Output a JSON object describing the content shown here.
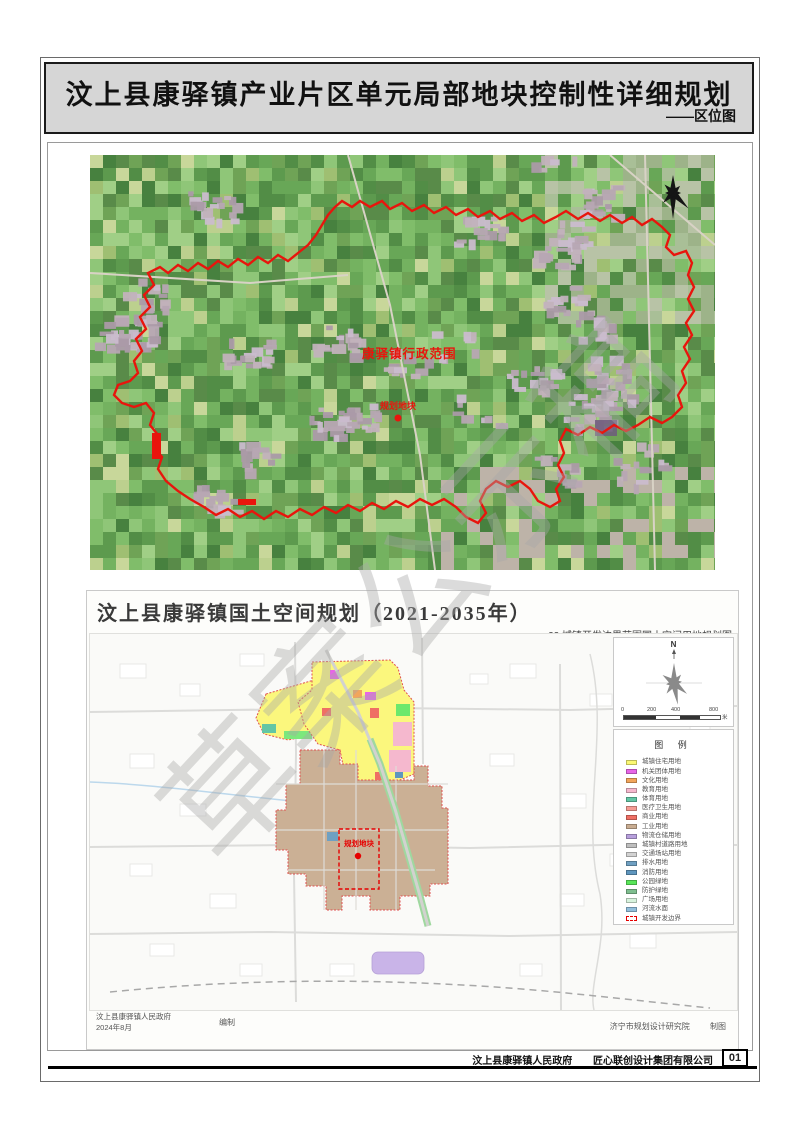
{
  "header": {
    "title": "汶上县康驿镇产业片区单元局部地块控制性详细规划",
    "subtitle": "——区位图"
  },
  "watermark": "草案公示稿",
  "satellite_map": {
    "region_label": "康驿镇行政范围",
    "plot_label": "规划地块",
    "boundary_color": "#e8150d"
  },
  "lower_map": {
    "title": "汶上县康驿镇国土空间规划（2021-2035年）",
    "subtitle": "22 城镇开发边界范围国土空间用地规划图",
    "north_label": "N",
    "scale_bar": {
      "ticks": [
        "0",
        "200",
        "400",
        "800"
      ],
      "unit": "米"
    },
    "legend_title": "图 例",
    "legend": [
      {
        "label": "城镇住宅用地",
        "color": "#fbf873",
        "type": "fill"
      },
      {
        "label": "机关团体用地",
        "color": "#e766e7",
        "type": "fill"
      },
      {
        "label": "文化用地",
        "color": "#f2a55b",
        "type": "fill"
      },
      {
        "label": "教育用地",
        "color": "#f5b8ce",
        "type": "fill"
      },
      {
        "label": "体育用地",
        "color": "#63c6a5",
        "type": "fill"
      },
      {
        "label": "医疗卫生用地",
        "color": "#f49c94",
        "type": "fill"
      },
      {
        "label": "商业用地",
        "color": "#ef6f64",
        "type": "fill"
      },
      {
        "label": "工业用地",
        "color": "#c9ad92",
        "type": "fill"
      },
      {
        "label": "物流仓储用地",
        "color": "#b79fdc",
        "type": "fill"
      },
      {
        "label": "城镇村道路用地",
        "color": "#bebebe",
        "type": "fill"
      },
      {
        "label": "交通场站用地",
        "color": "#d2d2d2",
        "type": "fill"
      },
      {
        "label": "排水用地",
        "color": "#6fa0c2",
        "type": "fill"
      },
      {
        "label": "消防用地",
        "color": "#5e96be",
        "type": "fill"
      },
      {
        "label": "公园绿地",
        "color": "#59e659",
        "type": "fill"
      },
      {
        "label": "防护绿地",
        "color": "#7fbe8f",
        "type": "fill"
      },
      {
        "label": "广场用地",
        "color": "#d8f3de",
        "type": "fill"
      },
      {
        "label": "河流水面",
        "color": "#92bfdc",
        "type": "fill"
      },
      {
        "label": "城镇开发边界",
        "color": "#e60000",
        "type": "boundary"
      }
    ],
    "plot_label": "规划地块",
    "credits": {
      "left_org": "汶上县康驿镇人民政府",
      "left_date": "2024年8月",
      "left_role": "编制",
      "right_org": "济宁市规划设计研究院",
      "right_role": "制图"
    }
  },
  "footer": {
    "org_government": "汶上县康驿镇人民政府",
    "org_design": "匠心联创设计集团有限公司",
    "page_number": "01"
  }
}
